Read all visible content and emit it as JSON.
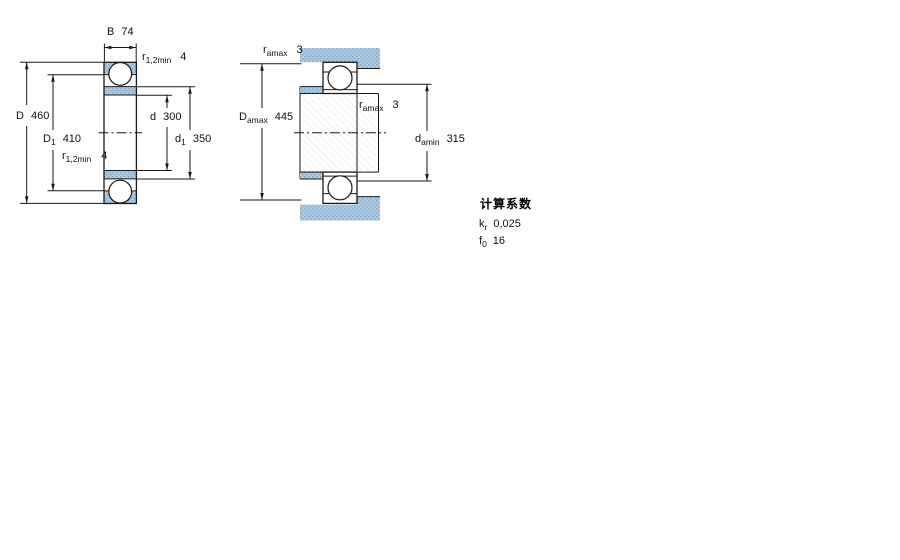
{
  "figure": {
    "kind": "deep-groove ball bearing technical drawing",
    "background": "#ffffff"
  },
  "colors": {
    "section_fill": "#aecbdf",
    "section_dot": "#7fa3c2",
    "line": "#1a1a1a",
    "hatch_line": "#e3e3e3"
  },
  "left_diagram": {
    "description": "bearing cross-section with boundary dimensions",
    "dims": {
      "B": {
        "label": "B",
        "sub": "",
        "value": "74"
      },
      "r_top": {
        "label": "r",
        "sub": "1,2min",
        "value": "4"
      },
      "D": {
        "label": "D",
        "sub": "",
        "value": "460"
      },
      "D1": {
        "label": "D",
        "sub": "1",
        "value": "410"
      },
      "r_bottom": {
        "label": "r",
        "sub": "1,2min",
        "value": "4"
      },
      "d": {
        "label": "d",
        "sub": "",
        "value": "300"
      },
      "d1": {
        "label": "d",
        "sub": "1",
        "value": "350"
      }
    }
  },
  "right_diagram": {
    "description": "bearing abutment and fillet dimensions",
    "dims": {
      "ra_top": {
        "label": "r",
        "sub": "amax",
        "value": "3"
      },
      "Da": {
        "label": "D",
        "sub": "amax",
        "value": "445"
      },
      "ra_mid": {
        "label": "r",
        "sub": "amax",
        "value": "3"
      },
      "da": {
        "label": "d",
        "sub": "amin",
        "value": "315"
      }
    }
  },
  "calculation_factors": {
    "title": "计算系数",
    "kr": {
      "label": "k",
      "sub": "r",
      "value": "0,025"
    },
    "f0": {
      "label": "f",
      "sub": "0",
      "value": "16"
    }
  }
}
